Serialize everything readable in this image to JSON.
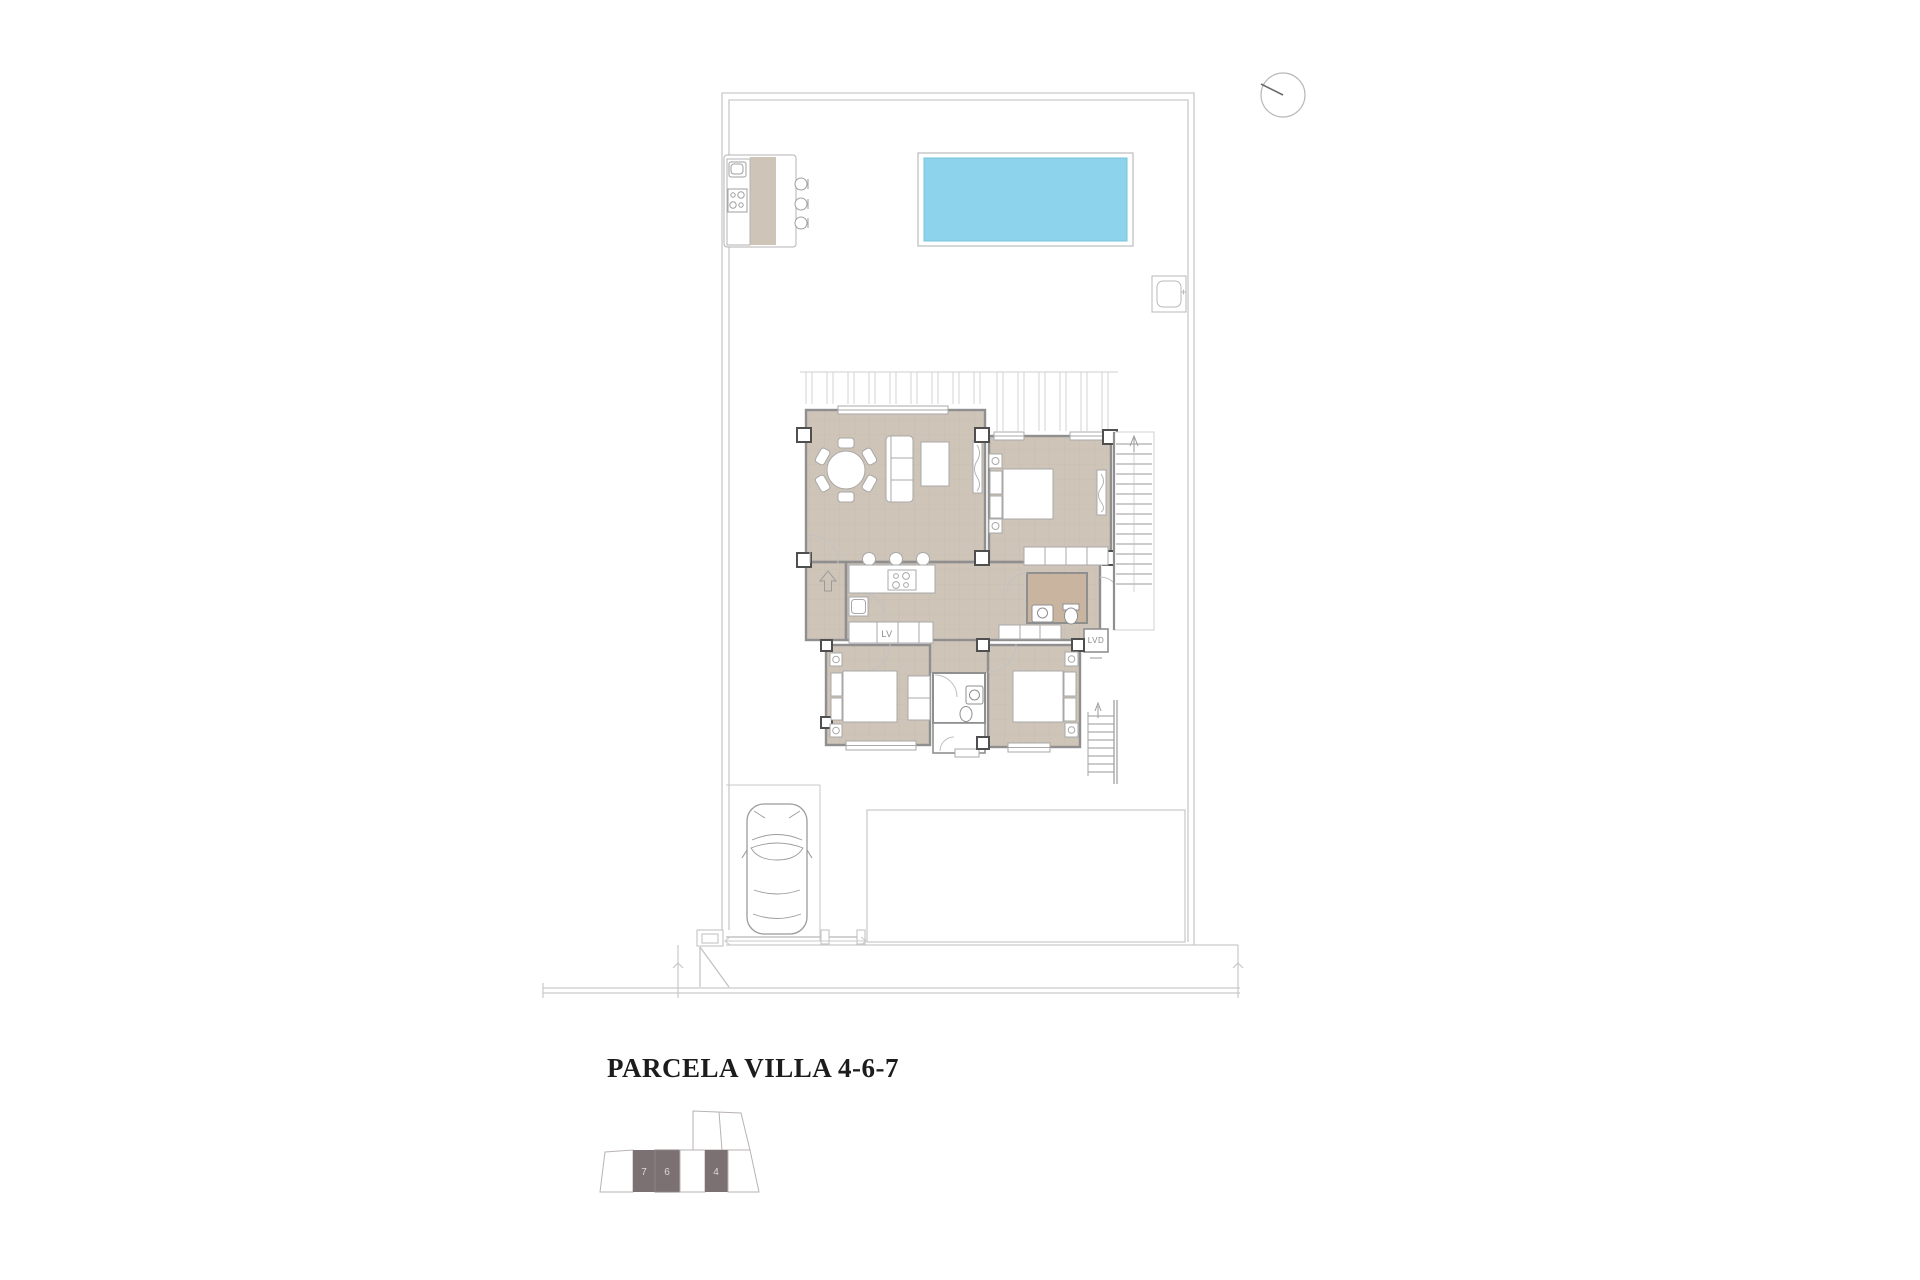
{
  "title": {
    "text": "PARCELA VILLA 4-6-7"
  },
  "plan": {
    "labels": {
      "dishwasher": "LV",
      "laundry": "LVD"
    },
    "key_plan": {
      "units": [
        {
          "number": "7",
          "highlighted": true
        },
        {
          "number": "6",
          "highlighted": true
        },
        {
          "number": "4",
          "highlighted": true
        }
      ]
    },
    "colors": {
      "floor_tile": "#cec4b7",
      "bathroom_floor": "#c8b49f",
      "pool_water": "#8ed3ec",
      "keyplan_unit_dark": "#7b7173",
      "wall_line": "#8f8f8f",
      "boundary_line": "#c9c9c9"
    }
  }
}
